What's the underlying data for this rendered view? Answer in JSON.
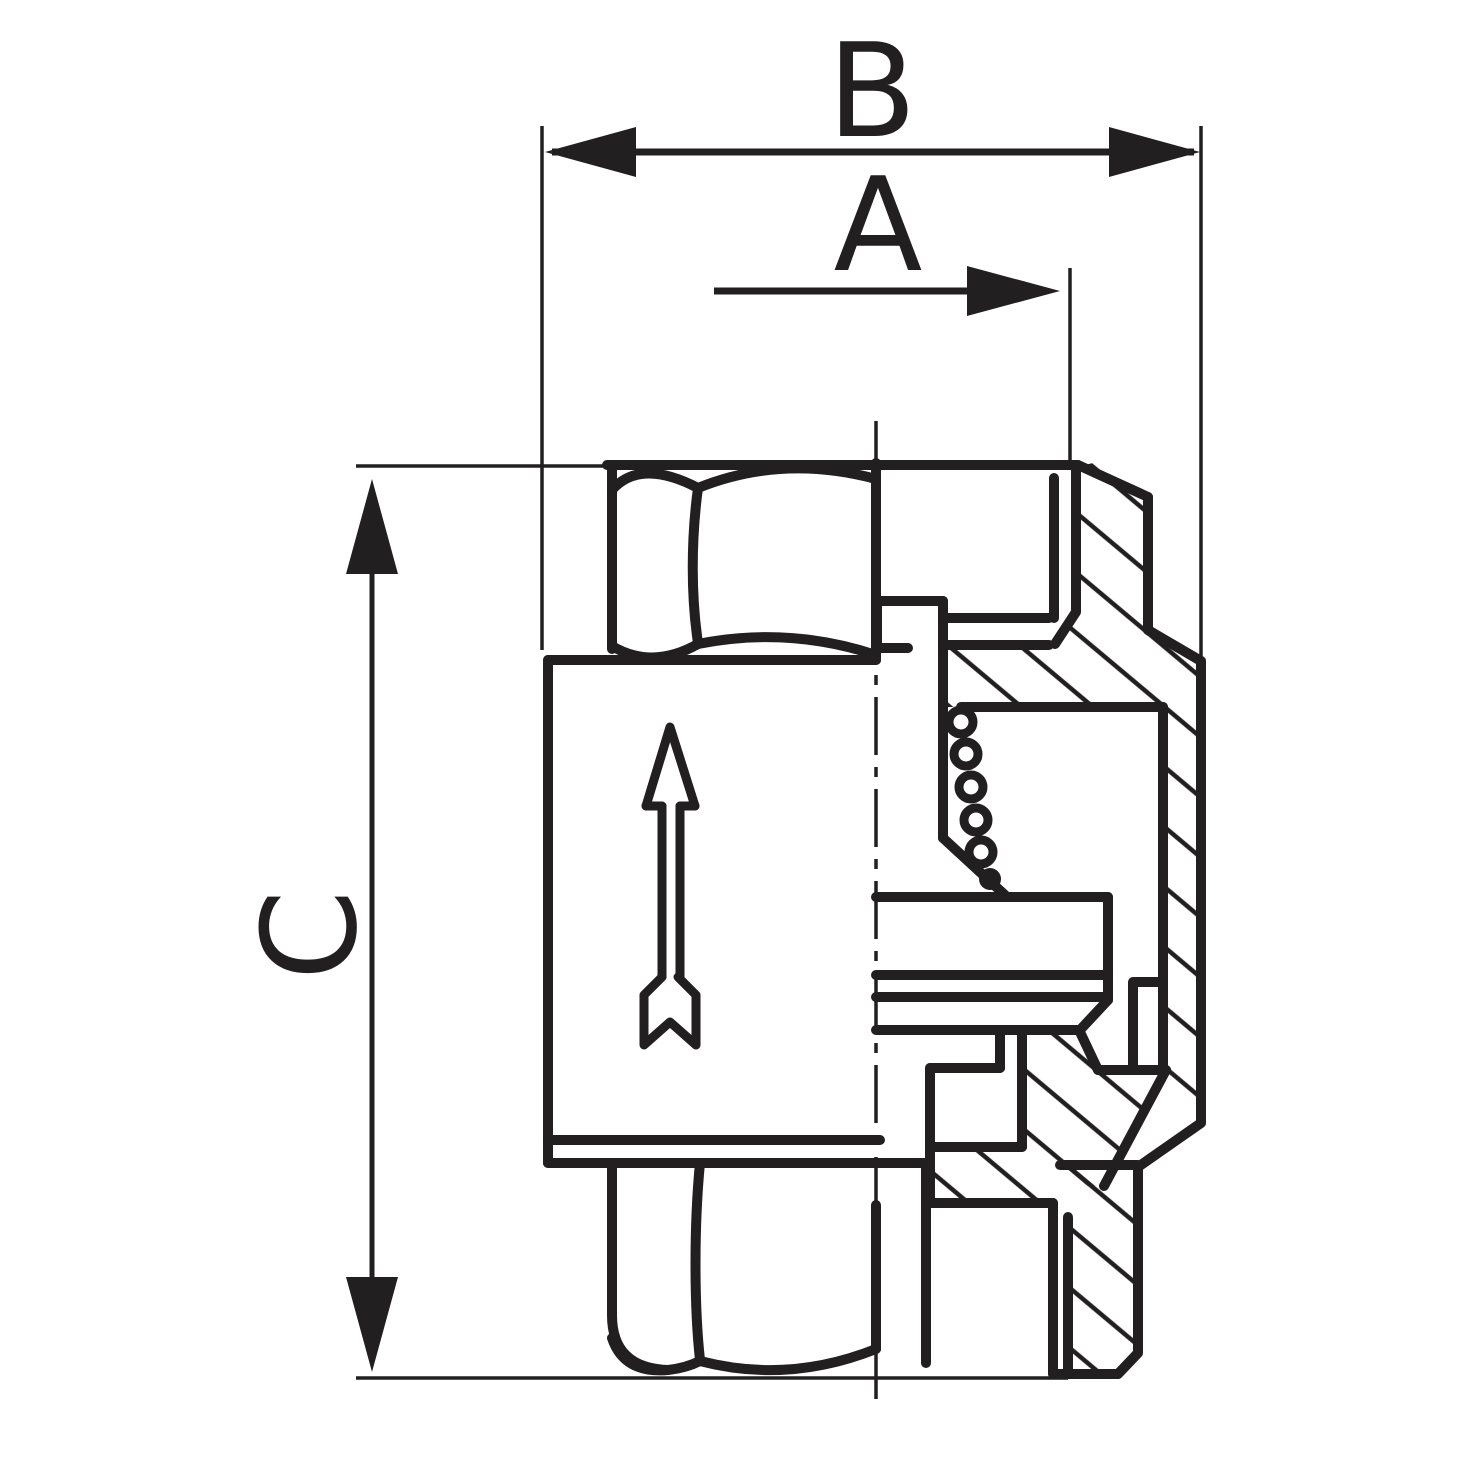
{
  "drawing": {
    "kind": "technical-cross-section",
    "subject": "inline spring check valve half-section",
    "line_color": "#221f20",
    "background_color": "#ffffff",
    "dimensions": {
      "b": "B",
      "a": "A",
      "c": "C"
    }
  }
}
